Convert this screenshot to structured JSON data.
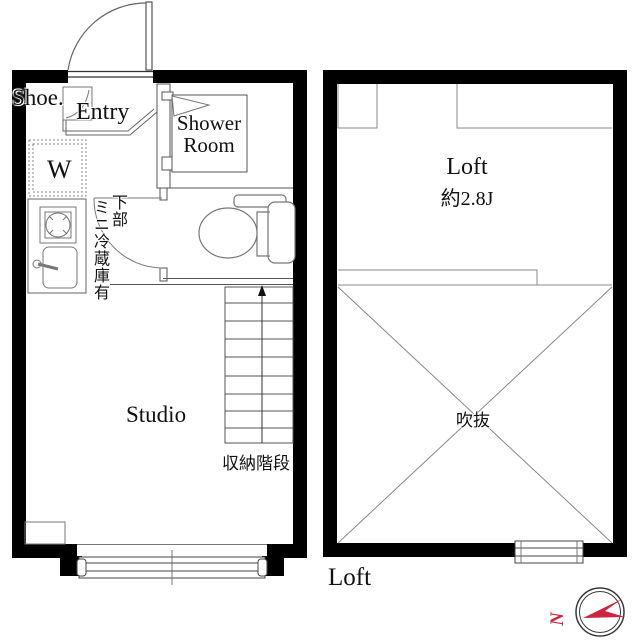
{
  "floorplan": {
    "left_plan": {
      "shoe_label": "Shoe.",
      "entry_label": "Entry",
      "shower_line1": "Shower",
      "shower_line2": "Room",
      "washer_label": "W",
      "fridge_note_col_right": "下部",
      "fridge_note_col_left": "ミニ冷蔵庫有",
      "studio_label": "Studio",
      "stairs_label": "収納階段"
    },
    "right_plan": {
      "room_label": "Loft",
      "size_label": "約2.8J",
      "void_label": "吹抜",
      "caption": "Loft"
    },
    "compass": {
      "letter": "N",
      "color": "#cf2440"
    }
  }
}
